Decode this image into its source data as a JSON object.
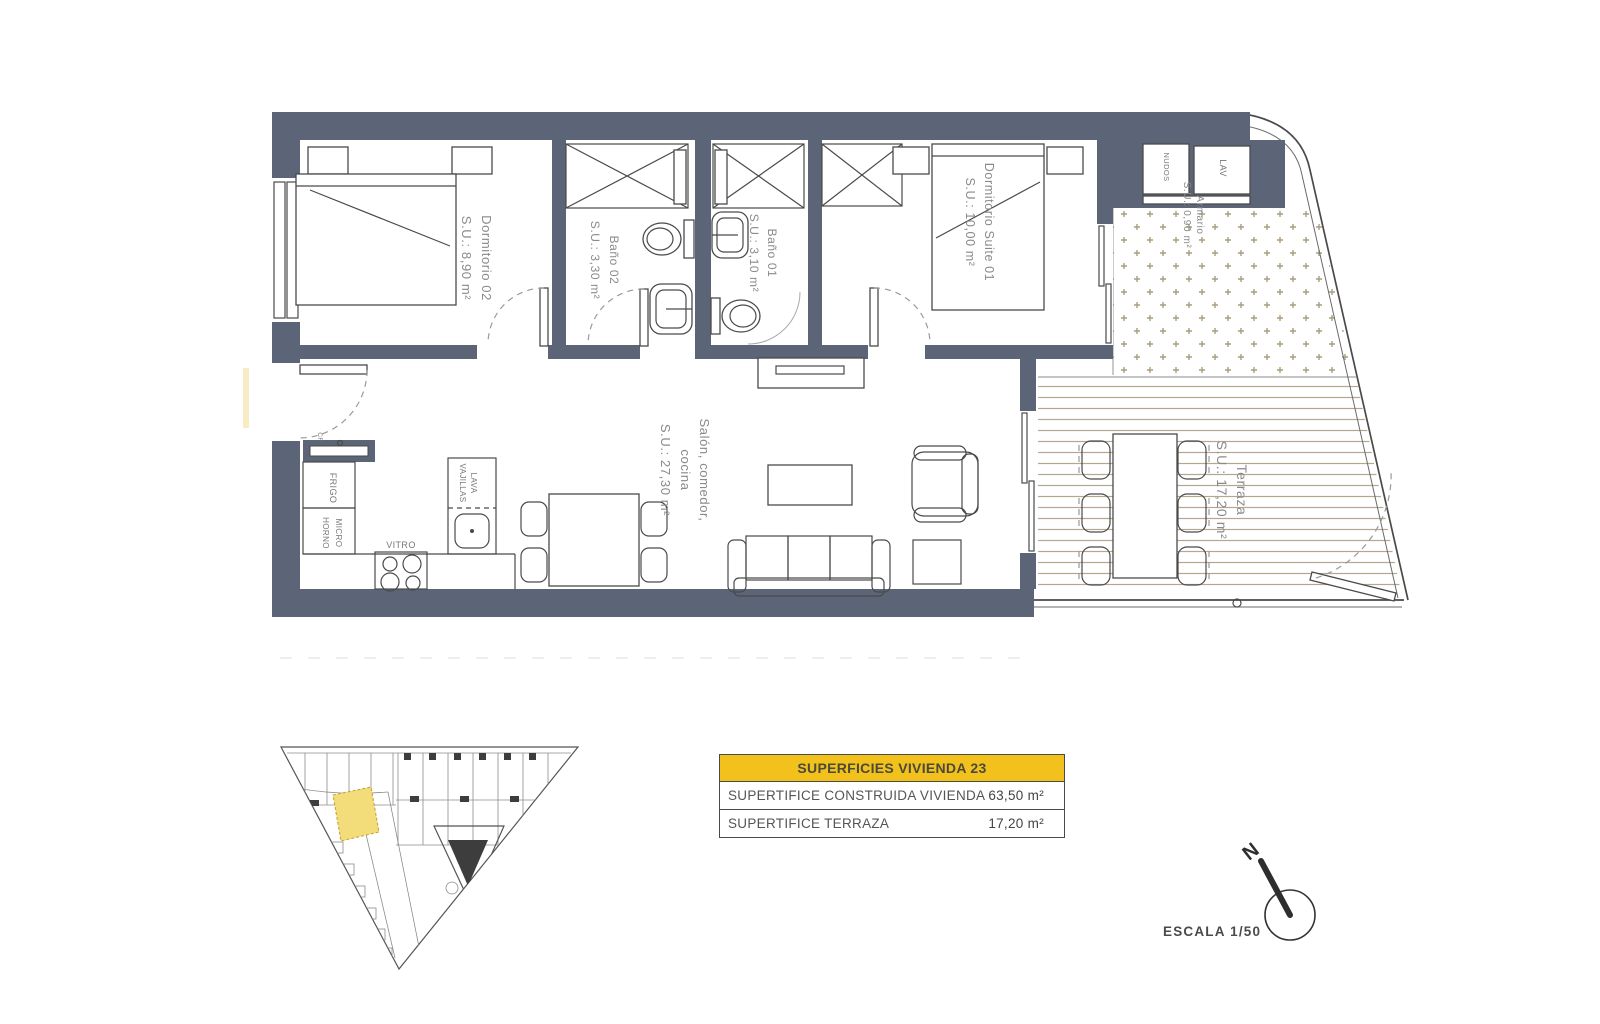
{
  "plan": {
    "rooms": {
      "dormitorio02": {
        "lines": [
          "Dormitorio 02",
          "S.U.: 8,90 m²"
        ]
      },
      "bano02": {
        "lines": [
          "Baño 02",
          "S.U.: 3,30 m²"
        ]
      },
      "bano01": {
        "lines": [
          "Baño 01",
          "S.U.: 3,10 m²"
        ]
      },
      "suite": {
        "lines": [
          "Dormitorio Suite 01",
          "S.U.: 10,00 m²"
        ]
      },
      "salon": {
        "lines": [
          "Salón, comedor,",
          "cocina",
          "S.U.: 27,30 m²"
        ]
      },
      "terraza": {
        "lines": [
          "Terraza",
          "S.U.: 17,20 m²"
        ]
      },
      "armario": {
        "lines": [
          "Armario",
          "S.U.: 0,90 m²"
        ]
      }
    },
    "appliances": {
      "frigo": "FRIGO",
      "horno": "HORNO",
      "micro": "MICRO",
      "vitro": "VITRO",
      "lava": "LAVA",
      "vajillas": "VAJILLAS",
      "lav": "LAV",
      "nudos": "NUDOS",
      "cf": "CF"
    }
  },
  "summary": {
    "title": "SUPERFICIES VIVIENDA 23",
    "rows": [
      {
        "label": "SUPERTIFICE CONSTRUIDA VIVIENDA",
        "value": "63,50 m²"
      },
      {
        "label": "SUPERTIFICE TERRAZA",
        "value": "17,20 m²"
      }
    ]
  },
  "footer": {
    "scale": "ESCALA 1/50",
    "north": "N"
  },
  "colors": {
    "wall": "#5B6577",
    "accent_yellow": "#F2C11C",
    "unit_highlight": "#F3DC7A",
    "deck_line": "#B3A78E",
    "pattern_cross": "#A89F7D"
  }
}
